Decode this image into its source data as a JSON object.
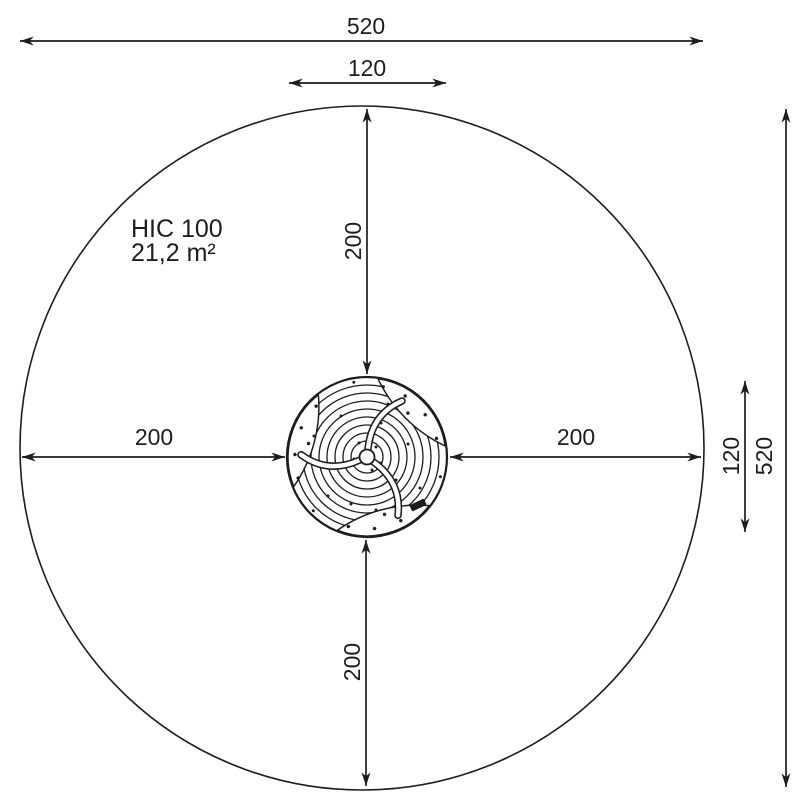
{
  "colors": {
    "line": "#1d1d1b",
    "background": "#ffffff"
  },
  "dims": {
    "outer_width": "520",
    "inner_width": "120",
    "radius_top": "200",
    "radius_bottom": "200",
    "radius_left": "200",
    "radius_right": "200",
    "inner_height": "120",
    "outer_height": "520"
  },
  "labels": {
    "hic": "HIC 100",
    "area": "21,2 m²"
  }
}
